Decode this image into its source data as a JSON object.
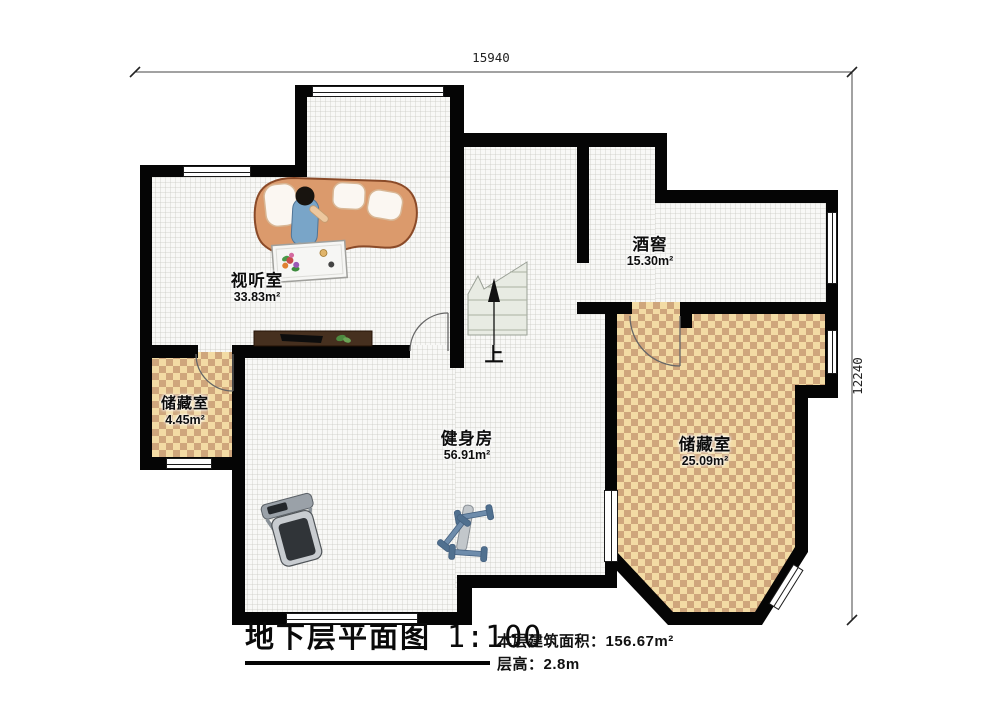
{
  "plan": {
    "dimension_top": "15940",
    "dimension_right": "12240",
    "stairs_label": "上",
    "rooms": [
      {
        "name": "视听室",
        "area": "33.83m²"
      },
      {
        "name": "酒窖",
        "area": "15.30m²"
      },
      {
        "name": "储藏室",
        "area": "4.45m²"
      },
      {
        "name": "健身房",
        "area": "56.91m²"
      },
      {
        "name": "储藏室",
        "area": "25.09m²"
      }
    ],
    "title_block": {
      "title": "地下层平面图",
      "scale": "1:100",
      "area_line": "本层建筑面积：156.67m²",
      "height_line": "层高：2.8m"
    }
  },
  "colors": {
    "wall": "#050505",
    "checker_light": "#f3dba4",
    "checker_dark": "#cfa67c",
    "sofa": "#db9a6c",
    "person_dress": "#79a5c8",
    "dumbbell": "#6e8cab",
    "stairs_fill": "#e8ebe3"
  }
}
